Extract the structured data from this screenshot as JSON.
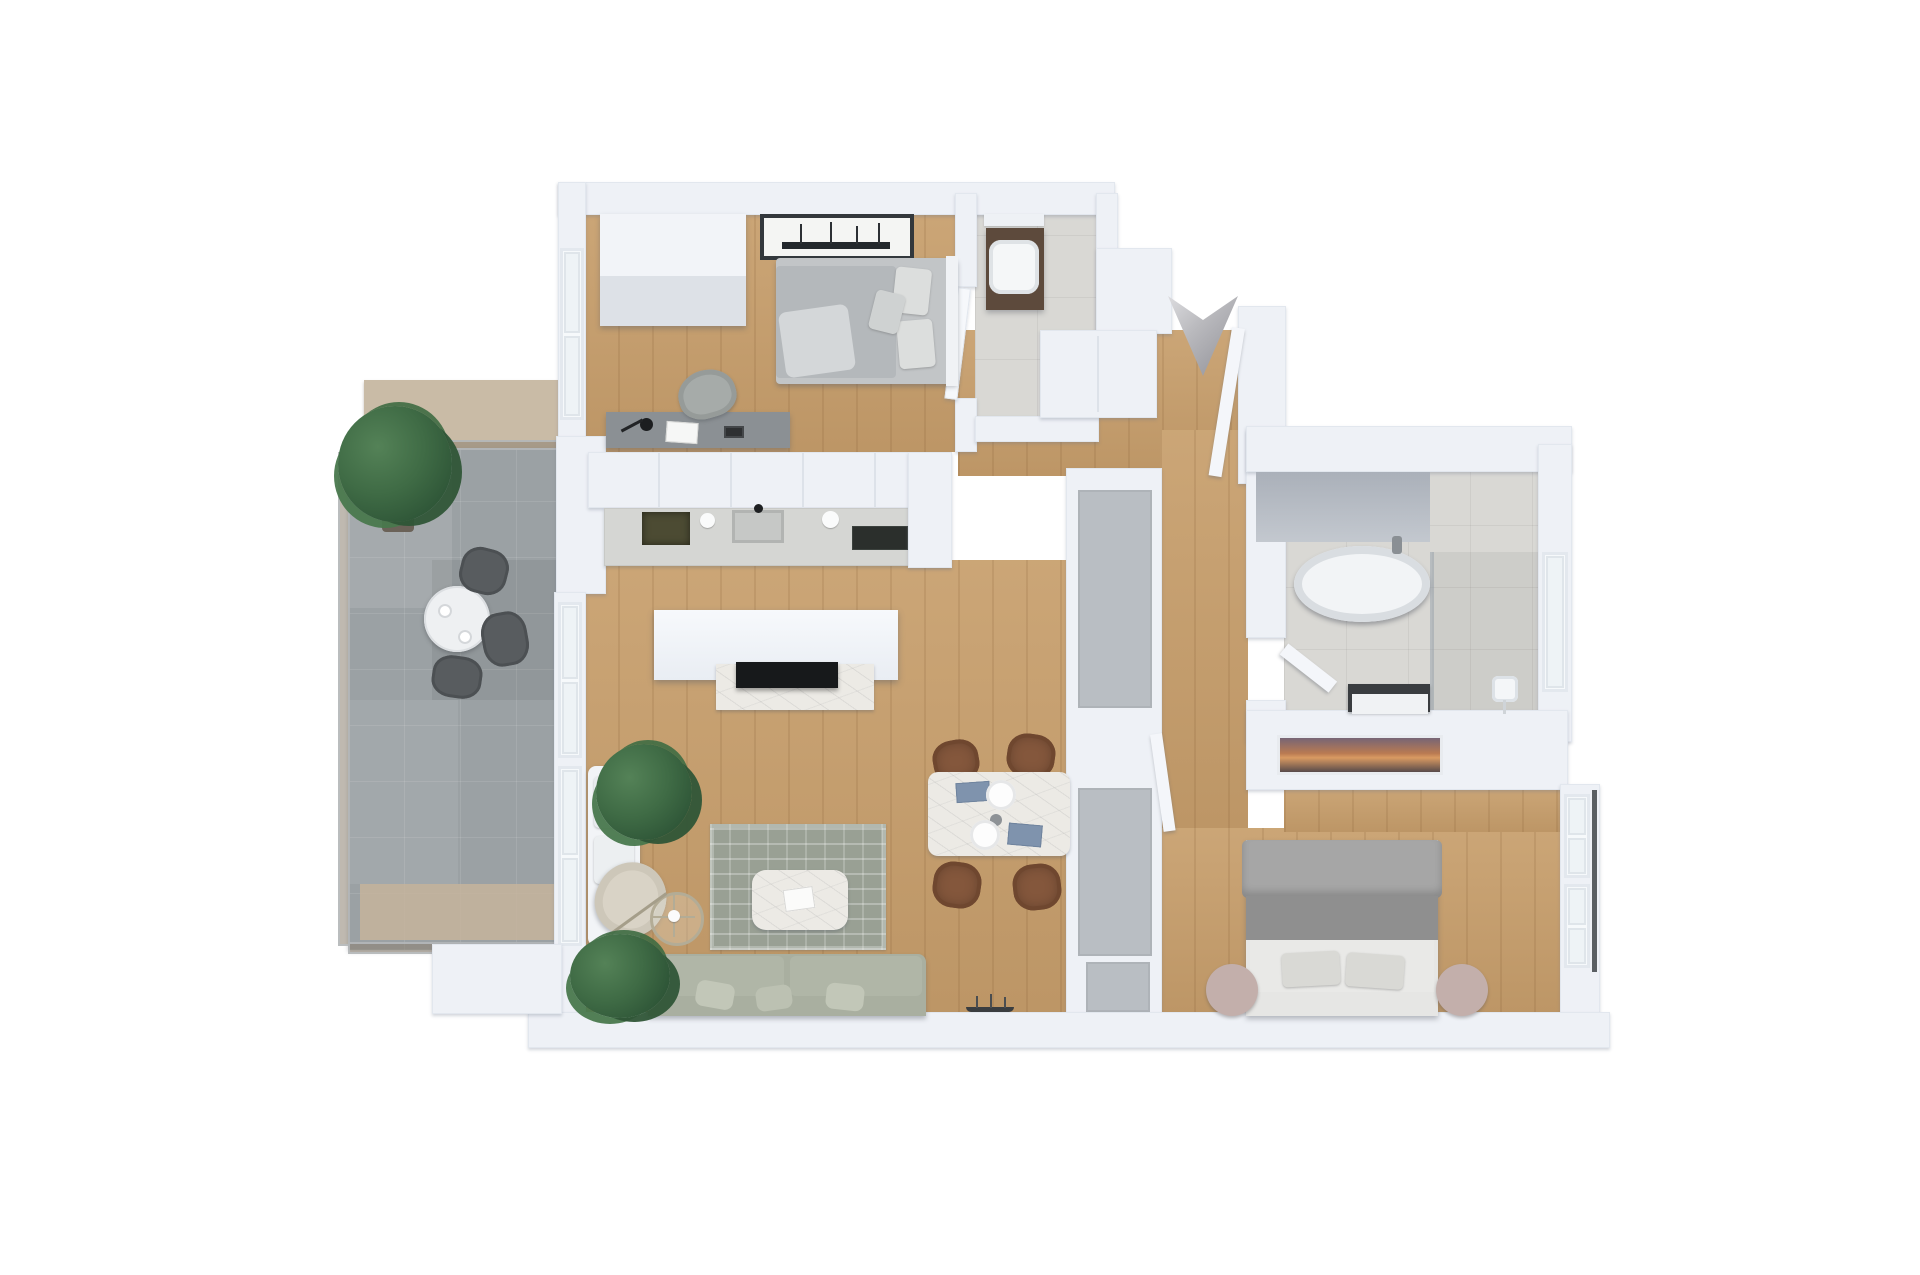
{
  "scene": {
    "type": "3d-floorplan-render",
    "view": "top-down-isometric",
    "background": "#ffffff",
    "no_visible_text": true
  },
  "palette": {
    "wall": "#eef1f6",
    "wall_edge": "#e2e7ee",
    "wood_floor": "#c8a06e",
    "bathroom_tile": "#d9d8d4",
    "balcony_tile": "#9ba1a4",
    "balcony_privacy_screen": "#c9bba6",
    "rug": "#99a094",
    "sofa": "#a9afa0",
    "armchair": "#d9d3c6",
    "marble": "#eceae5",
    "wicker_chair": "#84573c",
    "dark_wood_vanity": "#5d4a3c",
    "gray_closet_door": "#b9bec3",
    "plant_green": "#3f6b45",
    "tv_black": "#17191b",
    "metal_arrow": "#b9b9bd",
    "bed_gray": "#9c9c9c",
    "nightstand_pink": "#c3afab",
    "kitchen_counter": "#d5d6d3",
    "hob_dark_olive": "#4c4b33",
    "cooktop_black": "#2b2f2c"
  },
  "icons": {
    "entrance_arrow": "metallic chevron pointing down at the apartment entrance"
  },
  "rooms": {
    "bedroom_1": {
      "label": "bedroom-1",
      "floor": "wood",
      "furniture": [
        "wardrobe",
        "double-bed-gray-duvet",
        "marina-wall-art",
        "desk",
        "desk-lamp",
        "open-book",
        "alarm-clock",
        "desk-chair",
        "west-windows"
      ]
    },
    "shower_room": {
      "label": "shower-room",
      "floor": "tile",
      "furniture": [
        "floating-dark-wood-vanity",
        "white-washbasin",
        "wall-shelf"
      ]
    },
    "entry": {
      "label": "entry-hall",
      "floor": "wood",
      "furniture": [
        "hall-closet",
        "entrance-door-open",
        "entrance-arrow"
      ]
    },
    "kitchen": {
      "label": "kitchen",
      "floor": "wood",
      "furniture": [
        "upper-cabinet-row",
        "countertop",
        "dark-inset-hob",
        "sink",
        "black-faucet",
        "glass-cooktop",
        "tall-cabinet-unit"
      ]
    },
    "living_room": {
      "label": "living-room",
      "floor": "wood",
      "furniture": [
        "tv-partition-wall",
        "flat-tv",
        "marble-media-console",
        "area-rug",
        "marble-coffee-table",
        "book-on-table",
        "sage-sofa",
        "cream-armchair",
        "arc-floor-lamp",
        "potted-plant-north",
        "potted-plant-south",
        "white-daybed",
        "model-ship-decor"
      ]
    },
    "dining_area": {
      "label": "dining-area",
      "floor": "wood",
      "furniture": [
        "marble-dining-table",
        "wicker-chair-1",
        "wicker-chair-2",
        "wicker-chair-3",
        "wicker-chair-4",
        "plate-1",
        "plate-2",
        "blue-napkin-1",
        "blue-napkin-2",
        "small-vase"
      ]
    },
    "hallway": {
      "label": "hallway",
      "floor": "wood",
      "furniture": [
        "closet-column-gray-sliding-doors",
        "bedroom2-door-open",
        "bathroom-door-open"
      ]
    },
    "bathroom": {
      "label": "bathroom",
      "floor": "tile",
      "furniture": [
        "freestanding-oval-bathtub",
        "tub-faucet",
        "dark-counter-vanity",
        "walk-in-shower",
        "rain-shower-head",
        "glass-partition",
        "east-window"
      ]
    },
    "bedroom_2": {
      "label": "bedroom-2",
      "floor": "wood",
      "furniture": [
        "double-bed-gray-blanket",
        "round-nightstand-left",
        "round-nightstand-right",
        "sunset-wall-tv",
        "east-windows"
      ]
    },
    "balcony": {
      "label": "balcony",
      "floor": "gray-tile",
      "furniture": [
        "round-bistro-table",
        "cup-1",
        "cup-2",
        "outdoor-chair-1",
        "outdoor-chair-2",
        "outdoor-chair-3",
        "potted-tree",
        "glass-railing",
        "privacy-screen"
      ]
    }
  }
}
